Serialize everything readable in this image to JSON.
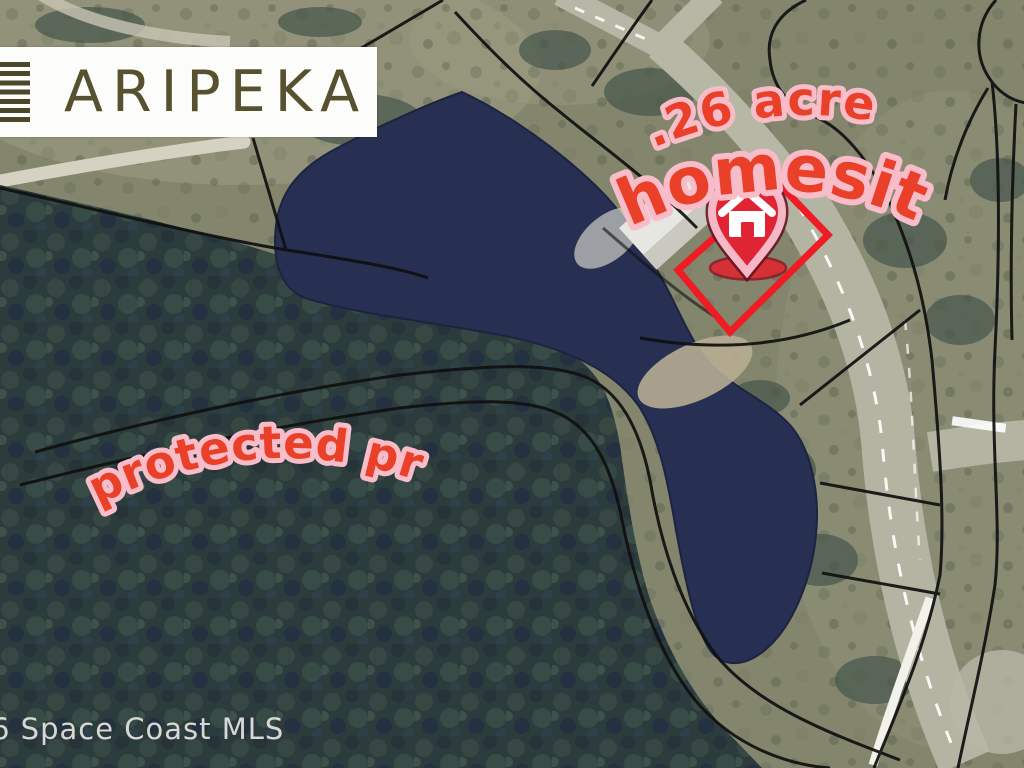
{
  "branding": {
    "logo_text": "ARIPEKA",
    "menu_icon": "horizontal-bars-icon"
  },
  "map_labels": {
    "acreage_line1": ".26 acre",
    "acreage_line2": "homesite!",
    "preserve": "protected preserve"
  },
  "watermark": {
    "text": "6 Space Coast MLS"
  },
  "marker": {
    "type": "home-location-pin",
    "house_icon": "house-icon"
  },
  "colors": {
    "label_red": "#ea3f28",
    "label_pink_outline": "#f9bdc9",
    "lot_outline_red": "#ee1c24",
    "pin_red": "#df2433",
    "pin_pink_ring": "#f6b7c6",
    "pond_navy": "#273052",
    "logo_olive": "#57512f"
  }
}
